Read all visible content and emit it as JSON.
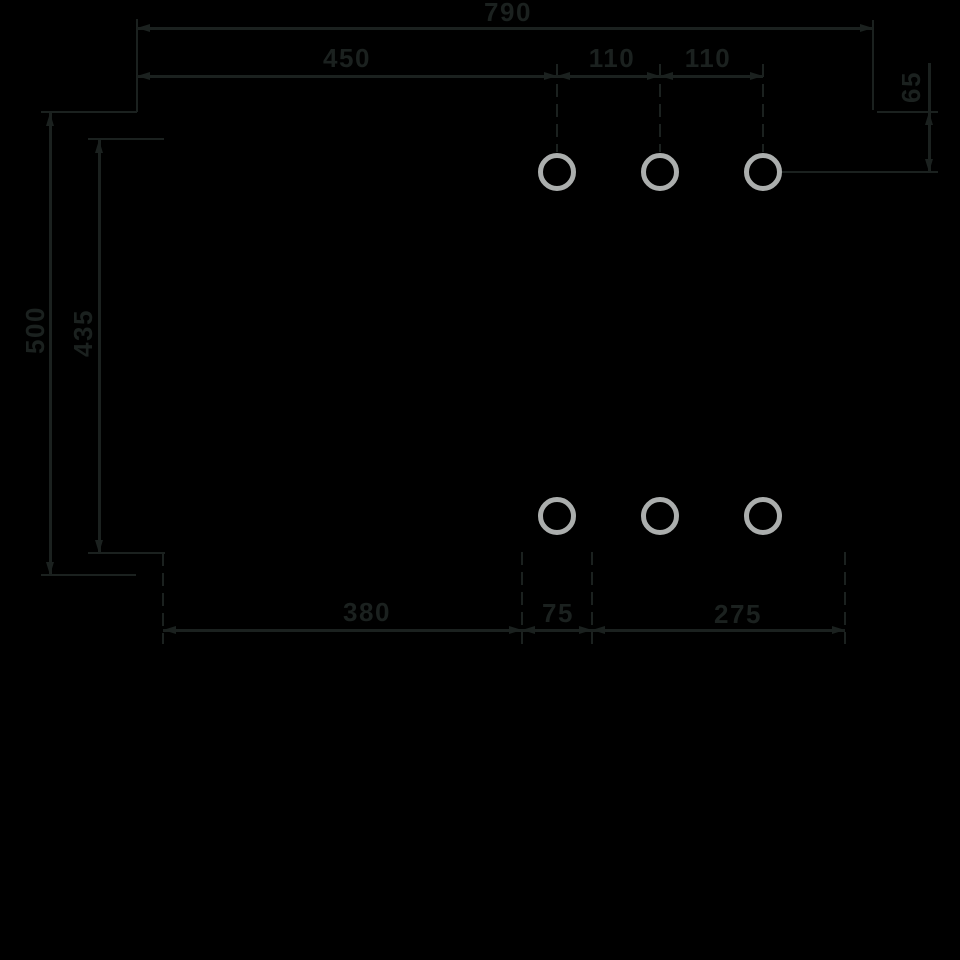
{
  "colors": {
    "background": "#000000",
    "line": "#1b211f",
    "hole_ring": "#abaead"
  },
  "dimensions": {
    "overall_width": {
      "label": "790"
    },
    "left_edge_to_first_hole": {
      "label": "450"
    },
    "hole_spacing_1": {
      "label": "110"
    },
    "hole_spacing_2": {
      "label": "110"
    },
    "top_edge_to_hole_row": {
      "label": "65"
    },
    "overall_height": {
      "label": "500"
    },
    "inner_height": {
      "label": "435"
    },
    "bottom_left_width": {
      "label": "380"
    },
    "bottom_slot_width": {
      "label": "75"
    },
    "bottom_right_width": {
      "label": "275"
    }
  },
  "holes": {
    "rows": 2,
    "columns": 3
  }
}
